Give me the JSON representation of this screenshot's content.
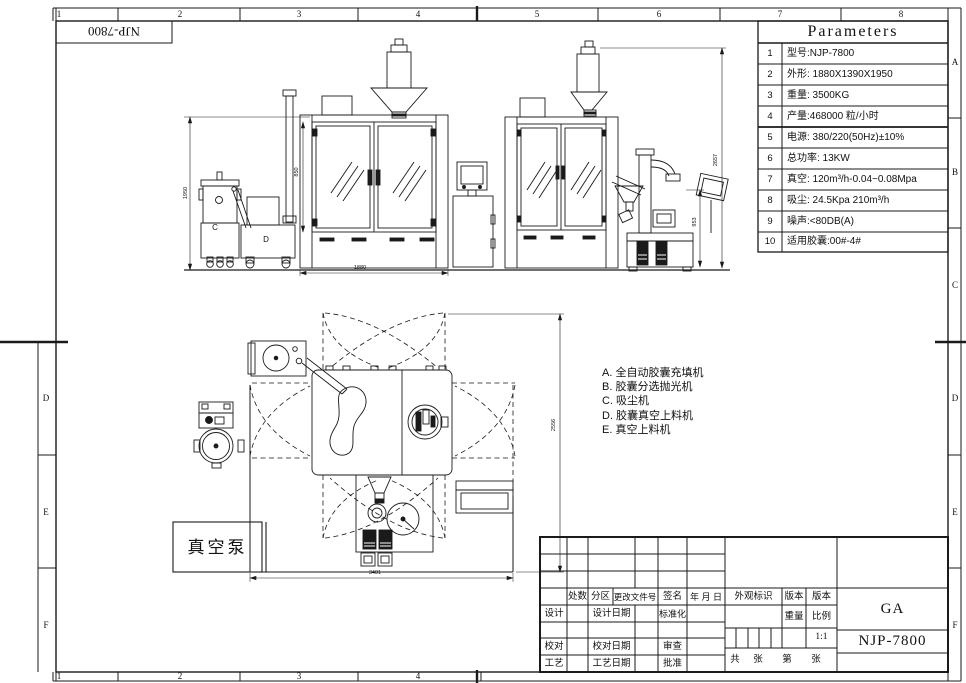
{
  "sheet": {
    "corner_model": "NJP-7800",
    "top_ruler": [
      "1",
      "2",
      "3",
      "4",
      "5",
      "6",
      "7",
      "8"
    ],
    "bottom_ruler": [
      "1",
      "2",
      "3",
      "4"
    ],
    "right_zone_letters": [
      "A",
      "B",
      "C",
      "D",
      "E",
      "F"
    ],
    "left_zone_letters": [
      "D",
      "E",
      "F"
    ]
  },
  "parameters_table": {
    "title": "Parameters",
    "rows": [
      {
        "num": "1",
        "text": "型号:NJP-7800"
      },
      {
        "num": "2",
        "text": "外形: 1880X1390X1950"
      },
      {
        "num": "3",
        "text": "重量: 3500KG"
      },
      {
        "num": "4",
        "text": "产量:468000 粒/小时"
      },
      {
        "num": "5",
        "text": "电源: 380/220(50Hz)±10%"
      },
      {
        "num": "6",
        "text": "总功率: 13KW"
      },
      {
        "num": "7",
        "text": "真空: 120m³/h-0.04~0.08Mpa"
      },
      {
        "num": "8",
        "text": "吸尘: 24.5Kpa 210m³/h"
      },
      {
        "num": "9",
        "text": "噪声:<80DB(A)"
      },
      {
        "num": "10",
        "text": "适用胶囊:00#-4#"
      }
    ]
  },
  "legend": {
    "items": [
      "A. 全自动胶囊充填机",
      "B. 胶囊分选抛光机",
      "C. 吸尘机",
      "D. 胶囊真空上料机",
      "E. 真空上料机"
    ]
  },
  "drawing": {
    "vacuum_pump_label": "真空泵",
    "machine_c_label": "C",
    "machine_d_label": "D",
    "dims": {
      "front_height": "1950",
      "door_height": "850",
      "front_width": "1880",
      "side_height": "2657",
      "side_lower": "953",
      "plan_width": "3481",
      "plan_depth": "2556"
    }
  },
  "title_block": {
    "col_qty": "处数",
    "col_zone": "分区",
    "col_change_no": "更改文件号",
    "col_sign": "签名",
    "col_date": "年 月 日",
    "appearance": "外观标识",
    "version_a": "版本",
    "version_b": "版本",
    "design": "设计",
    "design_date": "设计日期",
    "standardize": "标准化",
    "check": "校对",
    "check_date": "校对日期",
    "review": "审查",
    "process": "工艺",
    "process_date": "工艺日期",
    "approve": "批准",
    "weight": "重量",
    "scale": "比例",
    "scale_value": "1:1",
    "sheet_total": "共",
    "sheet_zhang1": "张",
    "sheet_no": "第",
    "sheet_zhang2": "张",
    "code": "GA",
    "model": "NJP-7800"
  }
}
